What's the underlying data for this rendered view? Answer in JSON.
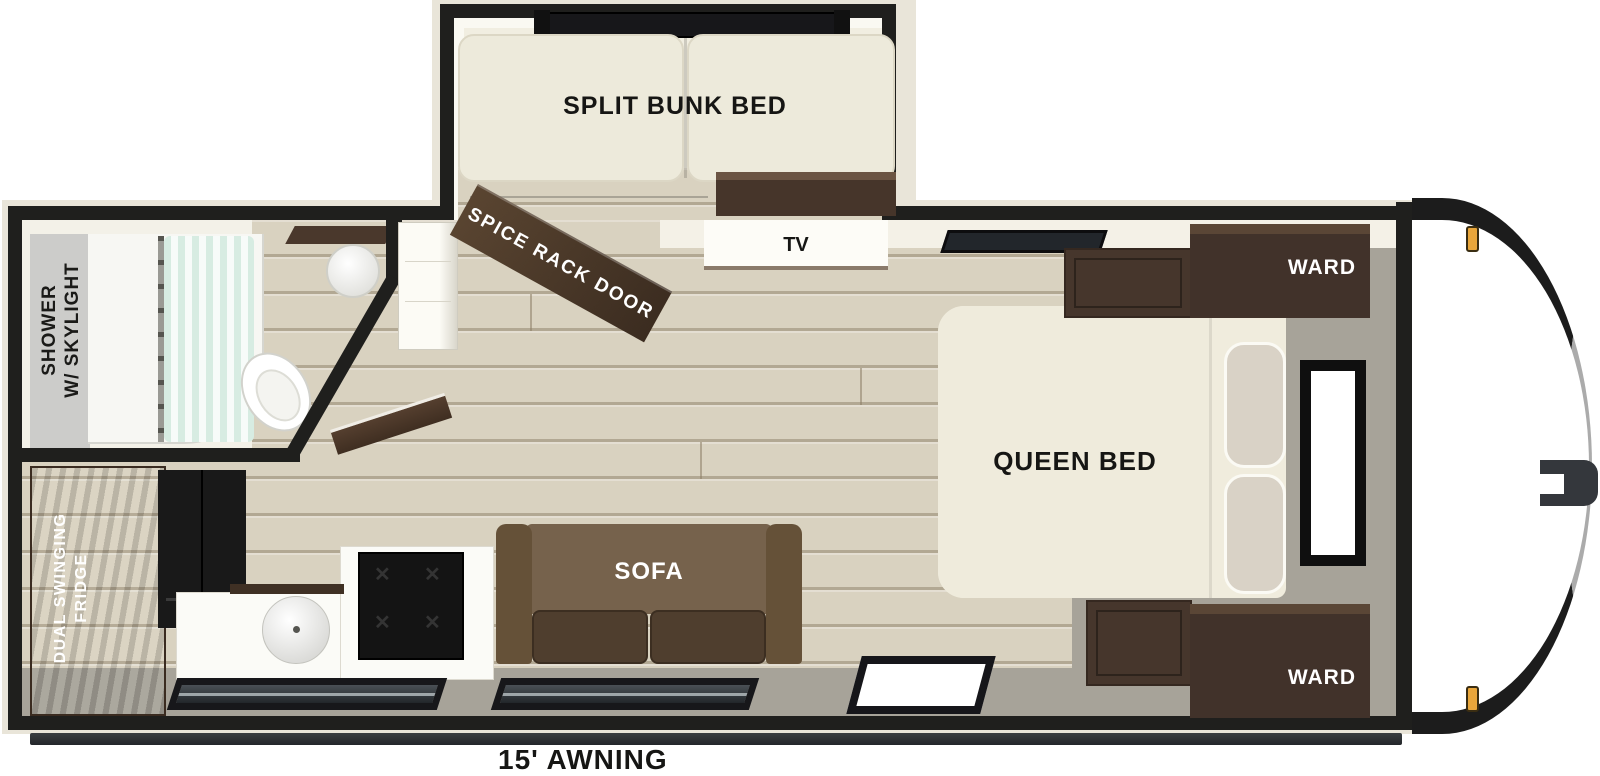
{
  "floorplan": {
    "labels": {
      "split_bunk_bed": "SPLIT BUNK BED",
      "spice_rack_door": "SPICE RACK DOOR",
      "tv": "TV",
      "shower_line1": "SHOWER",
      "shower_line2": "W/ SKYLIGHT",
      "queen_bed": "QUEEN BED",
      "ward_top": "WARD",
      "ward_bottom": "WARD",
      "sofa": "SOFA",
      "fridge_line1": "DUAL SWINGING",
      "fridge_line2": "FRIDGE",
      "awning": "15' AWNING"
    },
    "icons": {
      "burner": "✕"
    },
    "colors": {
      "wall": "#1f1f1d",
      "wood_floor": "#d9d2c0",
      "grey_floor": "#a7a399",
      "cabinet_brown": "#4a382c",
      "mattress_cream": "#edeadb",
      "sofa_brown": "#76624c",
      "curtain_mint": "#d7ece2",
      "marker_amber": "#e9a63b"
    }
  }
}
